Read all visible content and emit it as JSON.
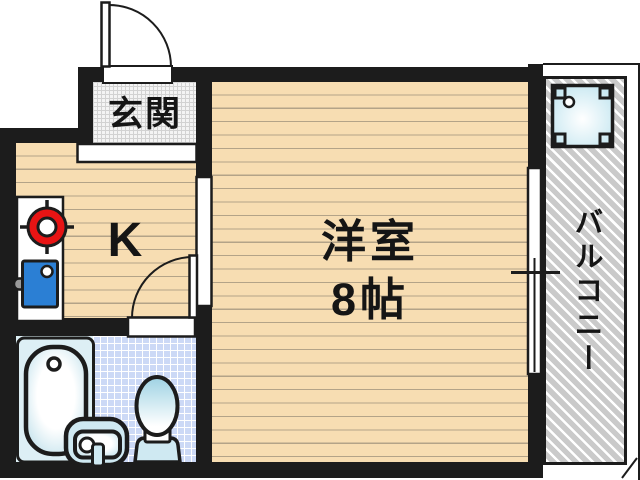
{
  "rooms": {
    "entrance": {
      "label": "玄関"
    },
    "kitchen": {
      "label": "K"
    },
    "western_room": {
      "name": "洋室",
      "size": "8帖"
    },
    "balcony": {
      "label": "バルコニー"
    }
  },
  "fixtures": [
    "entrance-door-swing",
    "bath-door-swing",
    "sliding-window",
    "stove-burner",
    "kitchen-sink",
    "bathtub",
    "washbasin",
    "toilet",
    "washing-machine-pan",
    "genkan-step"
  ],
  "colors": {
    "wall": "#1c1c1c",
    "floor_beige": "#f7ddb2",
    "floor_line": "#b3a388",
    "genkan_grid": "#d2d2d2",
    "bath_tile": "#ccd9f6",
    "fixture_blue": "#cfe9f2",
    "tub_surround": "#ddeff5",
    "stove_red": "#e81414",
    "sink_blue": "#2b7fd4",
    "handle_gray": "#9a9a9a",
    "balcony_stripe": "#cacaca"
  }
}
